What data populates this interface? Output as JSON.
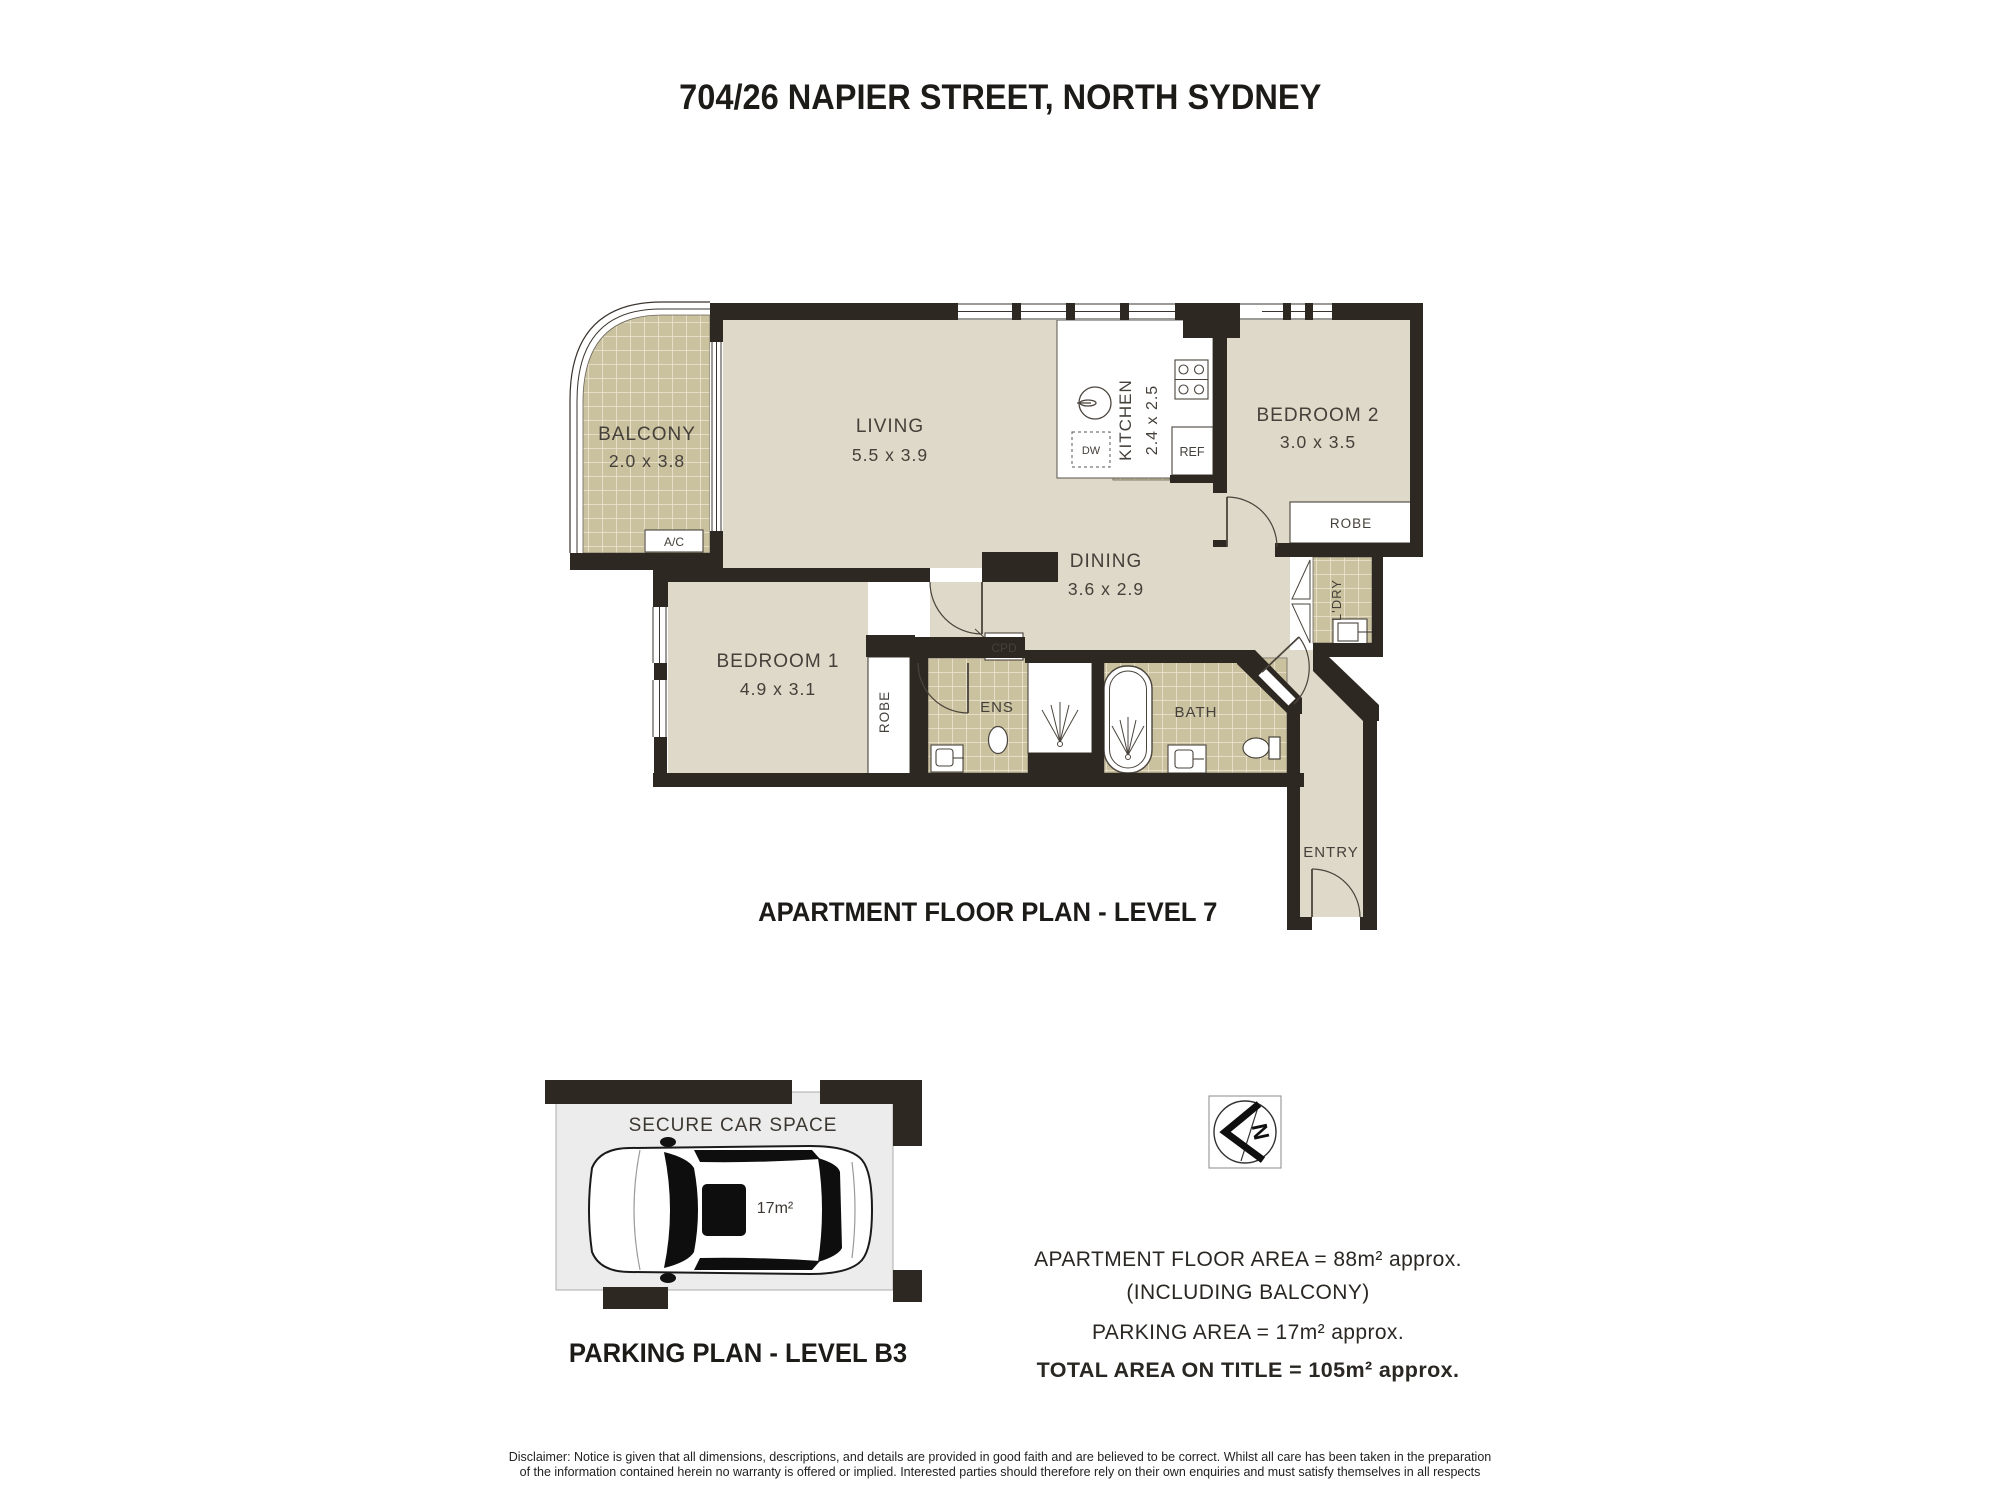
{
  "title": "704/26 NAPIER STREET, NORTH SYDNEY",
  "floor_plan": {
    "caption": "APARTMENT FLOOR PLAN - LEVEL 7",
    "rooms": {
      "balcony": {
        "name": "BALCONY",
        "dims": "2.0 x 3.8"
      },
      "living": {
        "name": "LIVING",
        "dims": "5.5 x 3.9"
      },
      "kitchen": {
        "name": "KITCHEN",
        "dims": "2.4 x 2.5"
      },
      "bedroom2": {
        "name": "BEDROOM 2",
        "dims": "3.0 x 3.5"
      },
      "dining": {
        "name": "DINING",
        "dims": "3.6 x 2.9"
      },
      "bedroom1": {
        "name": "BEDROOM 1",
        "dims": "4.9 x 3.1"
      },
      "ens": {
        "name": "ENS"
      },
      "bath": {
        "name": "BATH"
      },
      "laundry": {
        "name": "L'DRY"
      },
      "entry": {
        "name": "ENTRY"
      }
    },
    "fixtures": {
      "robe1": "ROBE",
      "robe2": "ROBE",
      "cupboard": "CPD",
      "air_conditioner": "A/C",
      "dishwasher": "DW",
      "refrigerator": "REF"
    }
  },
  "parking_plan": {
    "caption": "PARKING PLAN - LEVEL B3",
    "space_label": "SECURE CAR SPACE",
    "space_area": "17m²"
  },
  "compass": {
    "north_label": "N"
  },
  "areas": {
    "apartment": "APARTMENT FLOOR AREA = 88m² approx.",
    "apartment_note": "(INCLUDING BALCONY)",
    "parking": "PARKING AREA = 17m² approx.",
    "total": "TOTAL AREA ON TITLE = 105m² approx."
  },
  "disclaimer": {
    "line1": "Disclaimer: Notice is given that all dimensions, descriptions, and details are provided in good faith and are believed to be correct. Whilst all care has been taken in the preparation",
    "line2": "of the information contained herein no warranty is offered or implied. Interested parties should therefore rely on their own enquiries and must satisfy themselves in all respects"
  },
  "colors": {
    "wall": "#2e2822",
    "floor": "#ded9c8",
    "tile": "#cac19f",
    "tile_grid": "#ece5d2",
    "parking_floor": "#ececec"
  }
}
